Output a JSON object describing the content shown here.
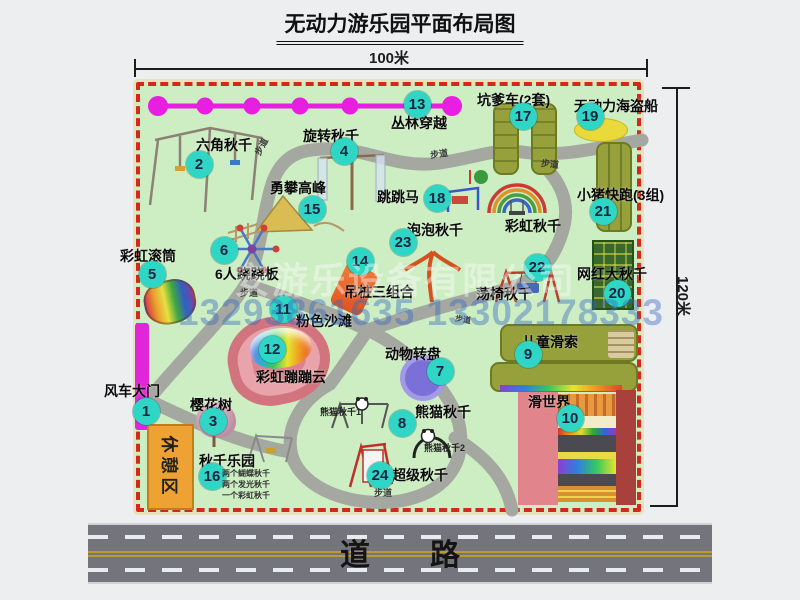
{
  "title": "无动力游乐园平面布局图",
  "dimensions": {
    "top": "100米",
    "right": "120米"
  },
  "road": {
    "label": "道　　路"
  },
  "watermark": {
    "company": "安游乐设备有限公司",
    "phone": "13293861635 13302178333"
  },
  "colors": {
    "park_green": "#cdedc3",
    "border_red": "#d3291d",
    "marker_teal": "#2fd6c6",
    "gate_magenta": "#e026d8",
    "zipline_magenta": "#e81ee0",
    "path_gray": "#a5a8a0",
    "olive_green": "#97a13c",
    "dark_green": "#37682c",
    "pirate_yellow": "#ead93a",
    "turntable_purple": "#7b70d8",
    "beach_pink": "#dc828c",
    "rest_orange": "#eda233",
    "road_gray": "#74747c"
  },
  "map": {
    "rest_area": "休憩区",
    "attractions": [
      {
        "num": "1",
        "label": "风车大门",
        "label_x": 104,
        "label_y": 381,
        "dot_x": 146,
        "dot_y": 411
      },
      {
        "num": "2",
        "label": "六角秋千",
        "label_x": 196,
        "label_y": 135,
        "dot_x": 199,
        "dot_y": 164
      },
      {
        "num": "3",
        "label": "樱花树",
        "label_x": 190,
        "label_y": 395,
        "dot_x": 213,
        "dot_y": 421
      },
      {
        "num": "4",
        "label": "旋转秋千",
        "label_x": 303,
        "label_y": 126,
        "dot_x": 344,
        "dot_y": 151
      },
      {
        "num": "5",
        "label": "彩虹滚筒",
        "label_x": 120,
        "label_y": 246,
        "dot_x": 152,
        "dot_y": 274
      },
      {
        "num": "6",
        "label": "6人跷跷板",
        "label_x": 215,
        "label_y": 264,
        "dot_x": 224,
        "dot_y": 250
      },
      {
        "num": "7",
        "label": "动物转盘",
        "label_x": 385,
        "label_y": 344,
        "dot_x": 440,
        "dot_y": 371
      },
      {
        "num": "8",
        "label": "熊猫秋千",
        "label_x": 415,
        "label_y": 402,
        "dot_x": 402,
        "dot_y": 423
      },
      {
        "num": "9",
        "label": "儿童滑索",
        "label_x": 522,
        "label_y": 332,
        "dot_x": 528,
        "dot_y": 354
      },
      {
        "num": "10",
        "label": "滑世界",
        "label_x": 528,
        "label_y": 392,
        "dot_x": 570,
        "dot_y": 418
      },
      {
        "num": "11",
        "label": "粉色沙滩",
        "label_x": 296,
        "label_y": 311,
        "dot_x": 283,
        "dot_y": 309
      },
      {
        "num": "12",
        "label": "彩虹蹦蹦云",
        "label_x": 256,
        "label_y": 367,
        "dot_x": 272,
        "dot_y": 349
      },
      {
        "num": "13",
        "label": "丛林穿越",
        "label_x": 391,
        "label_y": 113,
        "dot_x": 417,
        "dot_y": 104
      },
      {
        "num": "14",
        "label": "吊桩三组合",
        "label_x": 344,
        "label_y": 282,
        "dot_x": 360,
        "dot_y": 261
      },
      {
        "num": "15",
        "label": "勇攀高峰",
        "label_x": 270,
        "label_y": 178,
        "dot_x": 312,
        "dot_y": 209
      },
      {
        "num": "16",
        "label": "秋千乐园",
        "label_x": 199,
        "label_y": 451,
        "dot_x": 212,
        "dot_y": 476
      },
      {
        "num": "17",
        "label": "坑爹车(2套)",
        "label_x": 477,
        "label_y": 90,
        "dot_x": 523,
        "dot_y": 116
      },
      {
        "num": "18",
        "label": "跳跳马",
        "label_x": 377,
        "label_y": 187,
        "dot_x": 437,
        "dot_y": 198
      },
      {
        "num": "19",
        "label": "无动力海盗船",
        "label_x": 574,
        "label_y": 96,
        "dot_x": 590,
        "dot_y": 116
      },
      {
        "num": "20",
        "label": "网红大秋千",
        "label_x": 577,
        "label_y": 264,
        "dot_x": 617,
        "dot_y": 293
      },
      {
        "num": "21",
        "label": "小猪快跑(3组)",
        "label_x": 577,
        "label_y": 185,
        "dot_x": 603,
        "dot_y": 211
      },
      {
        "num": "22",
        "label": "荡椅秋千",
        "label_x": 476,
        "label_y": 284,
        "dot_x": 537,
        "dot_y": 267
      },
      {
        "num": "23",
        "label": "泡泡秋千",
        "label_x": 407,
        "label_y": 220,
        "dot_x": 403,
        "dot_y": 242
      },
      {
        "num": "24",
        "label": "超级秋千",
        "label_x": 392,
        "label_y": 465,
        "dot_x": 380,
        "dot_y": 475
      }
    ],
    "sub_labels": [
      {
        "text": "彩虹秋千",
        "x": 505,
        "y": 216,
        "size": 14,
        "rot": 0,
        "color": "#0a0a0a"
      },
      {
        "text": "熊猫秋千1",
        "x": 320,
        "y": 405,
        "size": 9,
        "rot": 0,
        "color": "#222222"
      },
      {
        "text": "熊猫秋千2",
        "x": 424,
        "y": 441,
        "size": 9,
        "rot": 0,
        "color": "#222222"
      },
      {
        "text": "两个蝴蝶秋千",
        "x": 222,
        "y": 468,
        "size": 8,
        "rot": 0,
        "color": "#333333"
      },
      {
        "text": "两个发光秋千",
        "x": 222,
        "y": 479,
        "size": 8,
        "rot": 0,
        "color": "#333333"
      },
      {
        "text": "一个彩虹秋千",
        "x": 222,
        "y": 490,
        "size": 8,
        "rot": 0,
        "color": "#333333"
      },
      {
        "text": "步道",
        "x": 252,
        "y": 140,
        "size": 9,
        "rot": -62,
        "color": "#3a3a3a"
      },
      {
        "text": "步道",
        "x": 430,
        "y": 147,
        "size": 9,
        "rot": -8,
        "color": "#3a3a3a"
      },
      {
        "text": "步道",
        "x": 541,
        "y": 157,
        "size": 9,
        "rot": 6,
        "color": "#3a3a3a"
      },
      {
        "text": "步道",
        "x": 240,
        "y": 286,
        "size": 9,
        "rot": 0,
        "color": "#3a3a3a"
      },
      {
        "text": "步道",
        "x": 455,
        "y": 314,
        "size": 8,
        "rot": 10,
        "color": "#3a3a3a"
      },
      {
        "text": "步道",
        "x": 374,
        "y": 486,
        "size": 9,
        "rot": 0,
        "color": "#3a3a3a"
      }
    ]
  }
}
